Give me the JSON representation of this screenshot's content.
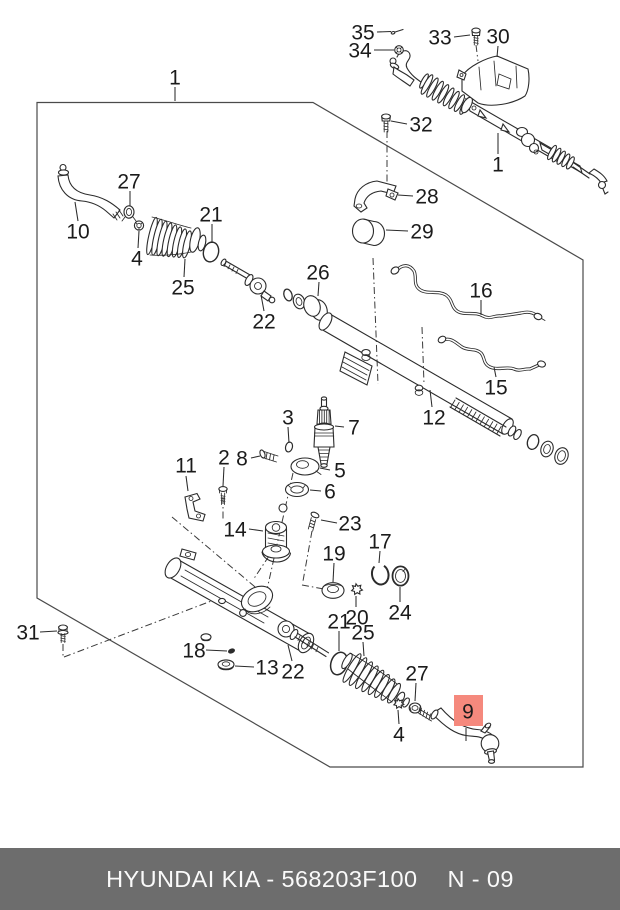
{
  "caption_bar": {
    "left_text": "HYUNDAI  KIA - 568203F100",
    "page_ref": "N - 09",
    "bg_color": "#6d6d6d",
    "text_color": "#fafafa"
  },
  "highlight": {
    "part": "9",
    "fill": "#f5897d",
    "text_color": "#993a2b",
    "rect": {
      "x": 454,
      "y": 695,
      "w": 29,
      "h": 31
    }
  },
  "diagram": {
    "label_color": "#1b1b1b",
    "line_color": "#2b2b2b",
    "labels": [
      {
        "id": "1-box",
        "text": "1",
        "x": 175,
        "y": 77,
        "leader": [
          175,
          87,
          175,
          101
        ]
      },
      {
        "id": "35",
        "text": "35",
        "x": 363,
        "y": 32,
        "leader": [
          377,
          32,
          391,
          31.5
        ]
      },
      {
        "id": "34",
        "text": "34",
        "x": 360,
        "y": 50,
        "leader": [
          374,
          50,
          394,
          50
        ]
      },
      {
        "id": "33",
        "text": "33",
        "x": 440,
        "y": 37,
        "leader": [
          454,
          37,
          470,
          35
        ]
      },
      {
        "id": "30",
        "text": "30",
        "x": 498,
        "y": 36,
        "leader": [
          498,
          46,
          497,
          57
        ]
      },
      {
        "id": "32",
        "text": "32",
        "x": 421,
        "y": 124,
        "leader": [
          407,
          124,
          391,
          121
        ]
      },
      {
        "id": "1-assembly",
        "text": "1",
        "x": 498,
        "y": 164,
        "leader": [
          498,
          154,
          498,
          133
        ]
      },
      {
        "id": "28",
        "text": "28",
        "x": 427,
        "y": 196,
        "leader": [
          413,
          196,
          398,
          195
        ]
      },
      {
        "id": "29",
        "text": "29",
        "x": 422,
        "y": 231,
        "leader": [
          408,
          231,
          386,
          230
        ]
      },
      {
        "id": "27-left",
        "text": "27",
        "x": 129,
        "y": 181,
        "leader": [
          130,
          191,
          130,
          206
        ]
      },
      {
        "id": "10",
        "text": "10",
        "x": 78,
        "y": 231,
        "leader": [
          78,
          221,
          75,
          202
        ]
      },
      {
        "id": "4-left",
        "text": "4",
        "x": 137,
        "y": 258,
        "leader": [
          138,
          248,
          139,
          231
        ]
      },
      {
        "id": "21-left",
        "text": "21",
        "x": 211,
        "y": 214,
        "leader": [
          212,
          224,
          212,
          243
        ]
      },
      {
        "id": "25-left",
        "text": "25",
        "x": 183,
        "y": 287,
        "leader": [
          184,
          277,
          185,
          259
        ]
      },
      {
        "id": "22-left",
        "text": "22",
        "x": 264,
        "y": 321,
        "leader": [
          264,
          311,
          261,
          295
        ]
      },
      {
        "id": "26",
        "text": "26",
        "x": 318,
        "y": 272,
        "leader": [
          319,
          282,
          318,
          296
        ]
      },
      {
        "id": "16",
        "text": "16",
        "x": 481,
        "y": 290,
        "leader": [
          481,
          300,
          481,
          315
        ]
      },
      {
        "id": "15",
        "text": "15",
        "x": 496,
        "y": 387,
        "leader": [
          496,
          377,
          494,
          367
        ]
      },
      {
        "id": "12",
        "text": "12",
        "x": 434,
        "y": 417,
        "leader": [
          432,
          407,
          430,
          390
        ]
      },
      {
        "id": "3",
        "text": "3",
        "x": 288,
        "y": 417,
        "leader": [
          288,
          427,
          289,
          443
        ]
      },
      {
        "id": "7",
        "text": "7",
        "x": 354,
        "y": 427,
        "leader": [
          344,
          427,
          335,
          426
        ]
      },
      {
        "id": "2",
        "text": "2",
        "x": 224,
        "y": 457,
        "leader": [
          224,
          467,
          223,
          486
        ]
      },
      {
        "id": "8",
        "text": "8",
        "x": 242,
        "y": 458,
        "leader": [
          251,
          458,
          260,
          456
        ]
      },
      {
        "id": "5",
        "text": "5",
        "x": 340,
        "y": 470,
        "leader": [
          330,
          470,
          320,
          468
        ]
      },
      {
        "id": "6",
        "text": "6",
        "x": 330,
        "y": 491,
        "leader": [
          321,
          491,
          310,
          490
        ]
      },
      {
        "id": "23",
        "text": "23",
        "x": 350,
        "y": 523,
        "leader": [
          337,
          523,
          321,
          520
        ]
      },
      {
        "id": "11",
        "text": "11",
        "x": 186,
        "y": 465,
        "leader": [
          186,
          476,
          188,
          491
        ]
      },
      {
        "id": "14",
        "text": "14",
        "x": 235,
        "y": 529,
        "leader": [
          249,
          529,
          263,
          531
        ]
      },
      {
        "id": "19",
        "text": "19",
        "x": 334,
        "y": 553,
        "leader": [
          334,
          563,
          333,
          582
        ]
      },
      {
        "id": "17",
        "text": "17",
        "x": 380,
        "y": 541,
        "leader": [
          380,
          551,
          379,
          563
        ]
      },
      {
        "id": "24",
        "text": "24",
        "x": 400,
        "y": 612,
        "leader": [
          400,
          602,
          400,
          587
        ]
      },
      {
        "id": "20",
        "text": "20",
        "x": 357,
        "y": 617,
        "leader": [
          356,
          607,
          356,
          596
        ]
      },
      {
        "id": "21-right",
        "text": "21",
        "x": 339,
        "y": 621,
        "leader": [
          339,
          631,
          339,
          651
        ]
      },
      {
        "id": "25-right",
        "text": "25",
        "x": 363,
        "y": 632,
        "leader": [
          363,
          642,
          364,
          656
        ]
      },
      {
        "id": "18",
        "text": "18",
        "x": 194,
        "y": 650,
        "leader": [
          206,
          650,
          227,
          651
        ]
      },
      {
        "id": "13",
        "text": "13",
        "x": 267,
        "y": 667,
        "leader": [
          254,
          667,
          235,
          666
        ]
      },
      {
        "id": "22-right",
        "text": "22",
        "x": 293,
        "y": 671,
        "leader": [
          292,
          661,
          288,
          645
        ]
      },
      {
        "id": "31",
        "text": "31",
        "x": 28,
        "y": 632,
        "leader": [
          40,
          632,
          57,
          631
        ]
      },
      {
        "id": "27-right",
        "text": "27",
        "x": 417,
        "y": 673,
        "leader": [
          416,
          683,
          415,
          701
        ]
      },
      {
        "id": "4-right",
        "text": "4",
        "x": 399,
        "y": 734,
        "leader": [
          399,
          724,
          398,
          710
        ]
      },
      {
        "id": "9",
        "text": "9",
        "x": 468,
        "y": 711,
        "highlight": true,
        "leader": [
          466,
          728,
          466,
          741
        ]
      }
    ]
  }
}
